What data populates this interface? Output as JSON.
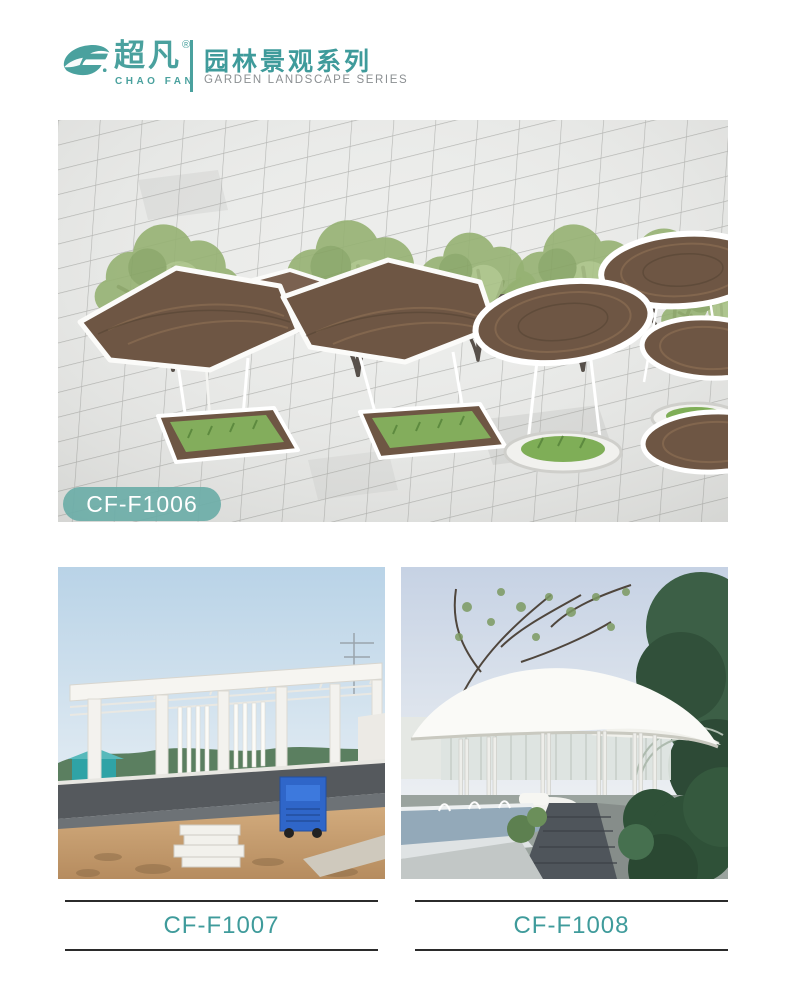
{
  "brand": {
    "logo_icon": "chaofan-swoosh-icon",
    "name_cn": "超凡",
    "reg_mark": "®",
    "name_en": "CHAO FAN",
    "series_title_cn": "园林景观系列",
    "series_title_en": "GARDEN LANDSCAPE SERIES",
    "accent_color": "#4aa19e",
    "series_en_color": "#8b8f92"
  },
  "products": {
    "featured": {
      "code": "CF-F1006",
      "badge_bg": "#6dada8",
      "badge_text_color": "#ffffff",
      "image": "3d-render-woven-canopy-plaza"
    },
    "items": [
      {
        "code": "CF-F1007",
        "image": "photo-white-pergola-construction"
      },
      {
        "code": "CF-F1008",
        "image": "photo-white-canopy-pavilion"
      }
    ],
    "caption_color": "#3f9b9b",
    "caption_line_color": "#2b2b2b"
  }
}
